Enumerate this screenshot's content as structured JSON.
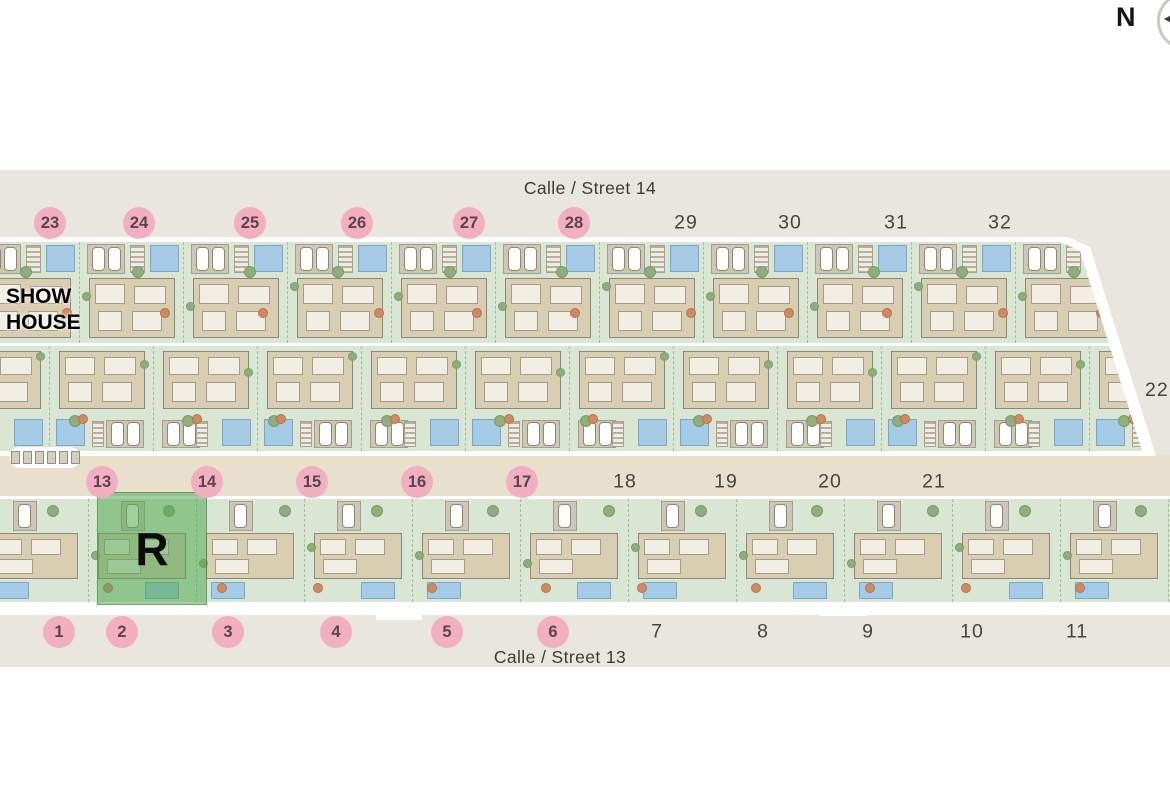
{
  "compass": {
    "label": "N"
  },
  "streets": {
    "top": "Calle / Street 14",
    "bottom": "Calle / Street 13"
  },
  "show_house": {
    "line1": "SHOW",
    "line2": "HOUSE"
  },
  "reserved": {
    "label": "R"
  },
  "edge_plot": {
    "label": "22"
  },
  "plot_numbers": {
    "street14_row": {
      "y": 223,
      "items": [
        {
          "label": "23",
          "x": 50,
          "circled": true
        },
        {
          "label": "24",
          "x": 139,
          "circled": true
        },
        {
          "label": "25",
          "x": 250,
          "circled": true
        },
        {
          "label": "26",
          "x": 357,
          "circled": true
        },
        {
          "label": "27",
          "x": 469,
          "circled": true
        },
        {
          "label": "28",
          "x": 574,
          "circled": true
        },
        {
          "label": "29",
          "x": 686,
          "circled": false
        },
        {
          "label": "30",
          "x": 790,
          "circled": false
        },
        {
          "label": "31",
          "x": 896,
          "circled": false
        },
        {
          "label": "32",
          "x": 1000,
          "circled": false
        }
      ]
    },
    "middle_row": {
      "y": 482,
      "items": [
        {
          "label": "13",
          "x": 102,
          "circled": true
        },
        {
          "label": "14",
          "x": 207,
          "circled": true
        },
        {
          "label": "15",
          "x": 312,
          "circled": true
        },
        {
          "label": "16",
          "x": 417,
          "circled": true
        },
        {
          "label": "17",
          "x": 522,
          "circled": true
        },
        {
          "label": "18",
          "x": 625,
          "circled": false
        },
        {
          "label": "19",
          "x": 726,
          "circled": false
        },
        {
          "label": "20",
          "x": 830,
          "circled": false
        },
        {
          "label": "21",
          "x": 934,
          "circled": false
        }
      ]
    },
    "street13_row": {
      "y": 632,
      "items": [
        {
          "label": "1",
          "x": 59,
          "circled": true
        },
        {
          "label": "2",
          "x": 122,
          "circled": true
        },
        {
          "label": "3",
          "x": 228,
          "circled": true
        },
        {
          "label": "4",
          "x": 336,
          "circled": true
        },
        {
          "label": "5",
          "x": 447,
          "circled": true
        },
        {
          "label": "6",
          "x": 553,
          "circled": true
        },
        {
          "label": "7",
          "x": 657,
          "circled": false
        },
        {
          "label": "8",
          "x": 763,
          "circled": false
        },
        {
          "label": "9",
          "x": 868,
          "circled": false
        },
        {
          "label": "10",
          "x": 972,
          "circled": false
        },
        {
          "label": "11",
          "x": 1077,
          "circled": false
        }
      ]
    }
  },
  "colors": {
    "street_gray": "#e9e6e0",
    "street_beige": "#e9dfcd",
    "plot_green": "#d9e6d3",
    "house_tan": "#d9cdb2",
    "room_white": "#f2eee4",
    "pool_blue": "#a5cbe7",
    "pool_border": "#7ba6c7",
    "tree_green": "#8fae7c",
    "tree_orange": "#cf8a63",
    "circle_pink": "#f2afc2",
    "circle_text": "#5c4350",
    "number_text": "#45453f",
    "reserved_green": "rgba(85,170,85,0.55)",
    "wall_gray": "#8d8779",
    "parking_pad": "#cfc7b6"
  }
}
